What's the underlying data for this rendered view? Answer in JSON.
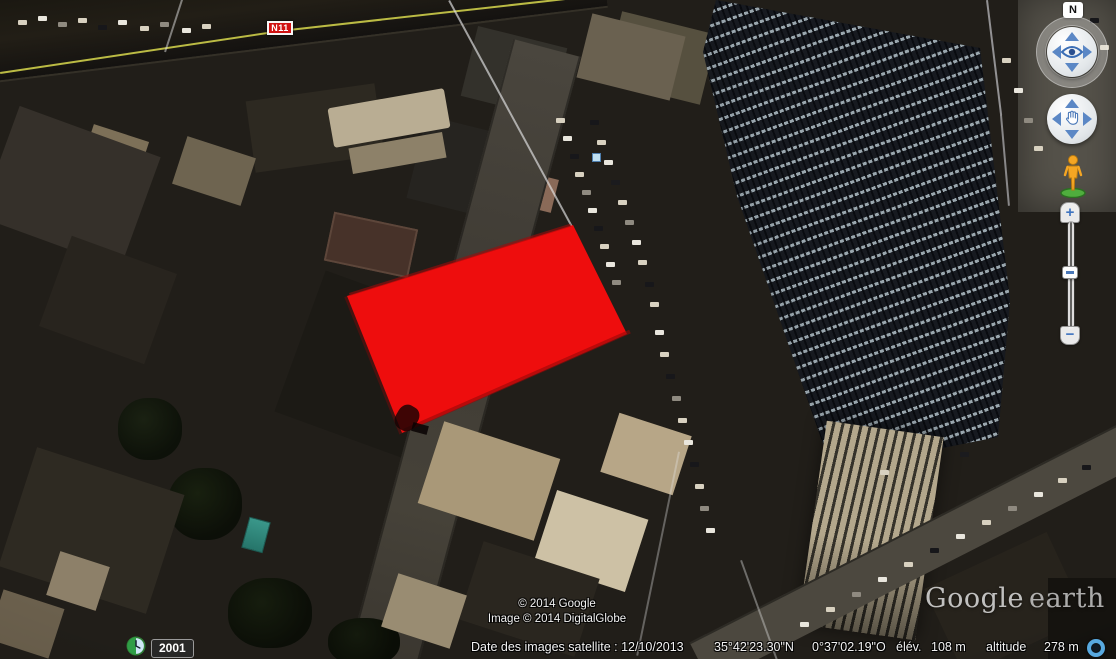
{
  "colors": {
    "polygon_red": "#ee0d0d",
    "road_line_yellow": "#cdcd4a",
    "control_arrow_blue": "#5b87c5",
    "streaming_ring_blue": "#58a9e0",
    "road_badge_red": "#d01212"
  },
  "map": {
    "road_badge_label": "N11"
  },
  "nav_controls": {
    "north_label": "N",
    "zoom_in_label": "+",
    "zoom_out_label": "−"
  },
  "time_control": {
    "year_label": "2001"
  },
  "attribution": {
    "line1": "© 2014 Google",
    "line2": "Image © 2014 DigitalGlobe"
  },
  "logo": {
    "brand": "Google",
    "product": "earth"
  },
  "status_bar": {
    "imagery_date": "Date des images satellite : 12/10/2013",
    "latitude": "35°42'23.30\"N",
    "longitude": "0°37'02.19\"O",
    "elevation_label": "élév.",
    "elevation_value": "108 m",
    "altitude_label": "altitude",
    "altitude_value": "278 m"
  }
}
